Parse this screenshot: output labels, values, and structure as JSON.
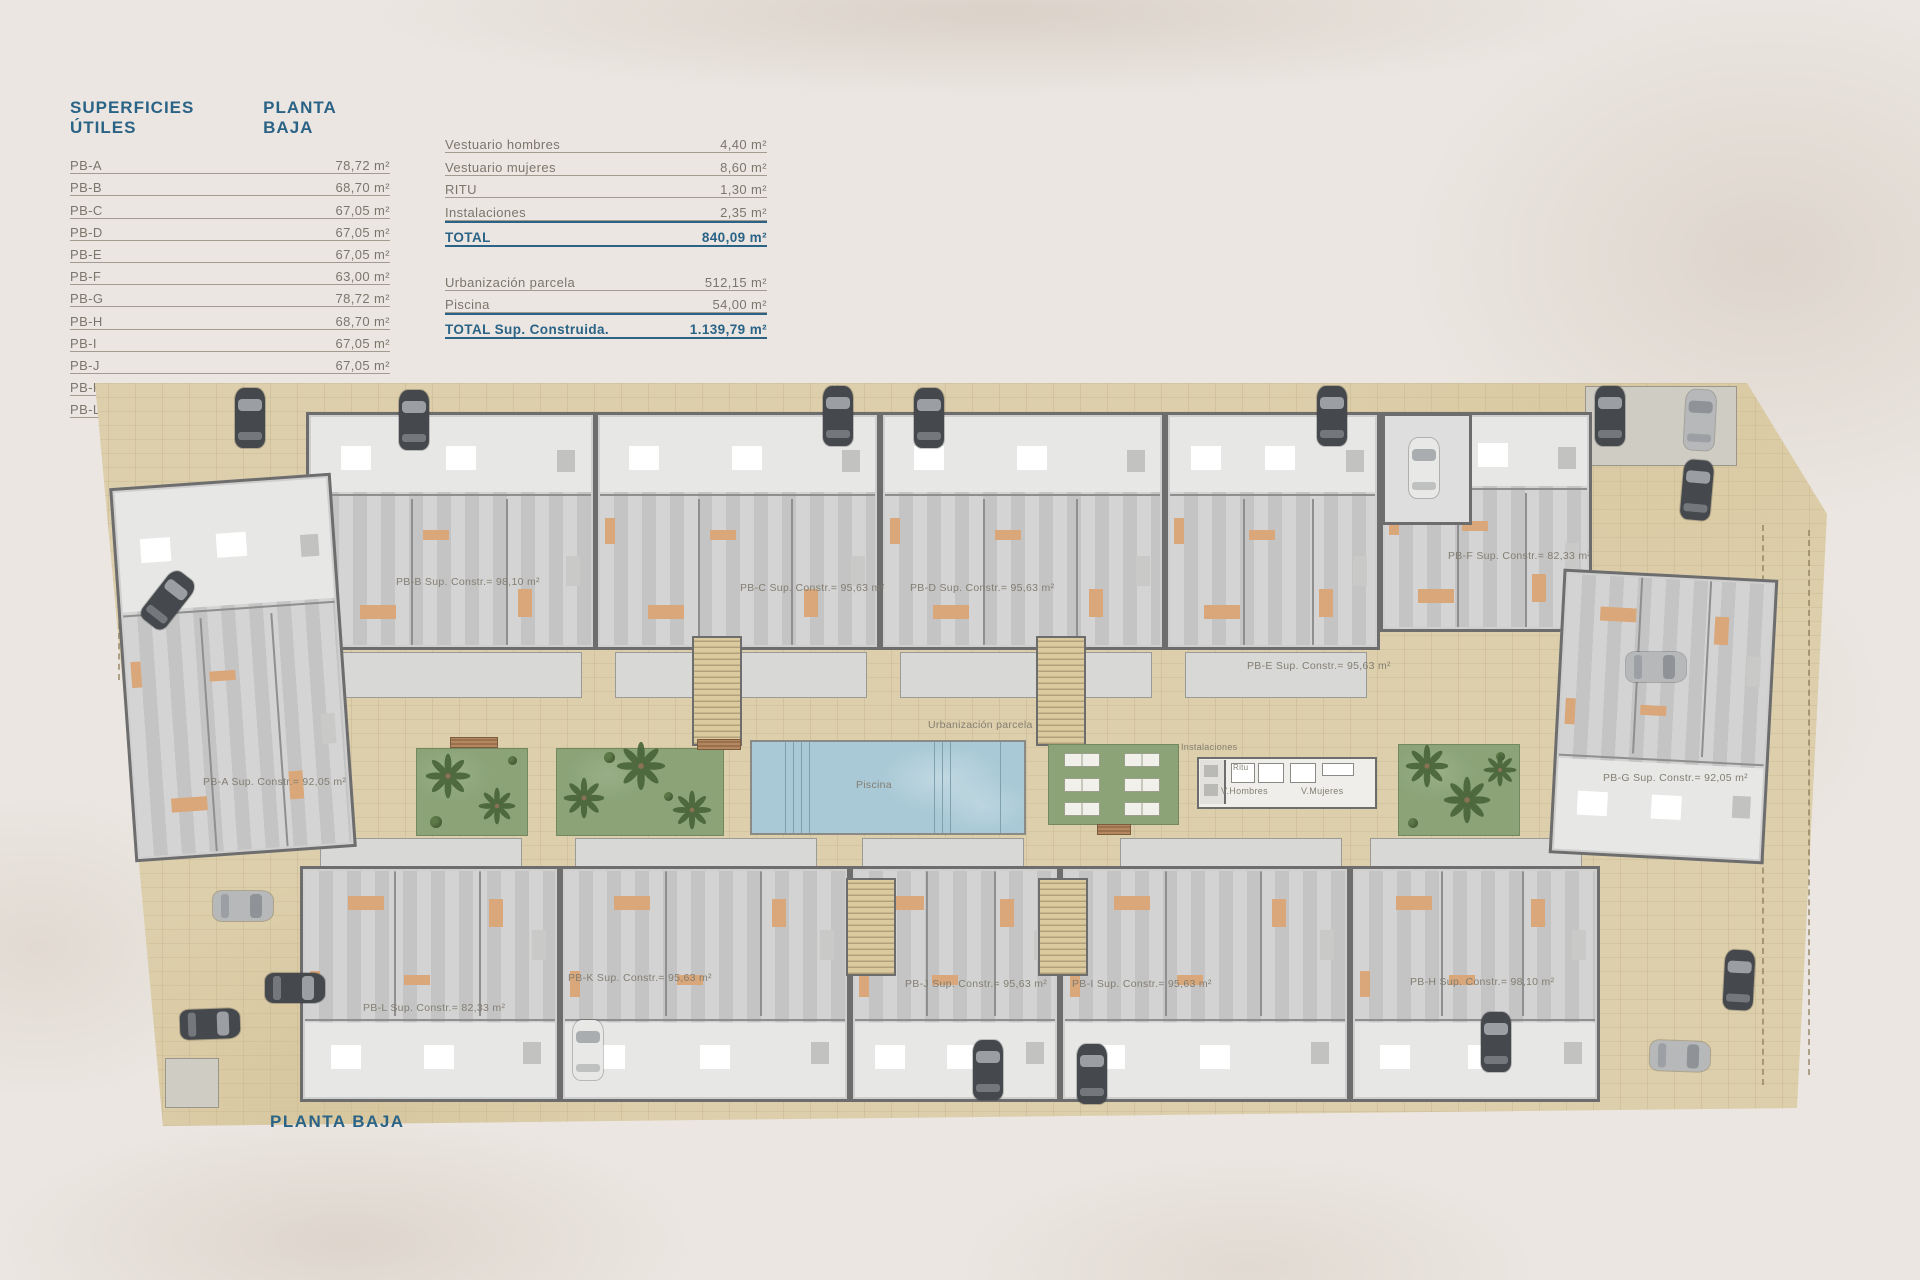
{
  "legend": {
    "title_left": "SUPERFICIES ÚTILES",
    "title_right": "PLANTA BAJA",
    "rows": [
      {
        "label": "PB-A",
        "value": "78,72 m²"
      },
      {
        "label": "PB-B",
        "value": "68,70 m²"
      },
      {
        "label": "PB-C",
        "value": "67,05 m²"
      },
      {
        "label": "PB-D",
        "value": "67,05 m²"
      },
      {
        "label": "PB-E",
        "value": "67,05 m²"
      },
      {
        "label": "PB-F",
        "value": "63,00 m²"
      },
      {
        "label": "PB-G",
        "value": "78,72 m²"
      },
      {
        "label": "PB-H",
        "value": "68,70 m²"
      },
      {
        "label": "PB-I",
        "value": "67,05 m²"
      },
      {
        "label": "PB-J",
        "value": "67,05 m²"
      },
      {
        "label": "PB-K",
        "value": "67,05 m²"
      },
      {
        "label": "PB-L",
        "value": "63,30 m²"
      }
    ]
  },
  "summary": {
    "rows1": [
      {
        "label": "Vestuario hombres",
        "value": "4,40 m²"
      },
      {
        "label": "Vestuario mujeres",
        "value": "8,60 m²"
      },
      {
        "label": "RITU",
        "value": "1,30 m²"
      },
      {
        "label": "Instalaciones",
        "value": "2,35 m²"
      }
    ],
    "total1": {
      "label": "TOTAL",
      "value": "840,09 m²"
    },
    "rows2": [
      {
        "label": "Urbanización parcela",
        "value": "512,15 m²"
      },
      {
        "label": "Piscina",
        "value": "54,00 m²"
      }
    ],
    "total2": {
      "label": "TOTAL Sup. Construida.",
      "value": "1.139,79 m²"
    }
  },
  "plan": {
    "title": "PLANTA BAJA",
    "units": [
      {
        "id": "PB-A",
        "label": "PB-A Sup. Constr.= 92,05 m²"
      },
      {
        "id": "PB-B",
        "label": "PB-B Sup. Constr.= 98,10 m²"
      },
      {
        "id": "PB-C",
        "label": "PB-C Sup. Constr.= 95,63 m²"
      },
      {
        "id": "PB-D",
        "label": "PB-D Sup. Constr.= 95,63 m²"
      },
      {
        "id": "PB-E",
        "label": "PB-E Sup. Constr.= 95,63 m²"
      },
      {
        "id": "PB-F",
        "label": "PB-F Sup. Constr.= 82,33 m²"
      },
      {
        "id": "PB-G",
        "label": "PB-G Sup. Constr.= 92,05 m²"
      },
      {
        "id": "PB-H",
        "label": "PB-H Sup. Constr.= 98,10 m²"
      },
      {
        "id": "PB-I",
        "label": "PB-I Sup. Constr.= 95,63 m²"
      },
      {
        "id": "PB-J",
        "label": "PB-J Sup. Constr.= 95,63 m²"
      },
      {
        "id": "PB-K",
        "label": "PB-K Sup. Constr.= 95,63 m²"
      },
      {
        "id": "PB-L",
        "label": "PB-L Sup. Constr.= 82,33 m²"
      }
    ],
    "labels": {
      "urbanizacion": "Urbanización parcela",
      "piscina": "Piscina",
      "instalaciones": "Instalaciones",
      "ritu": "Ritu",
      "v_hombres": "V.Hombres",
      "v_mujeres": "V.Mujeres"
    }
  },
  "colors": {
    "accent": "#2a6386",
    "ttext": "#7b766c",
    "tline": "#a19b90",
    "paving": "#ddcfab",
    "wall": "#6d6d6d",
    "floor": "#cfcfcf",
    "room": "#e7e7e5",
    "furn": "#d9a77a",
    "garden": "#8ba377",
    "palm": "#4a653a",
    "pool": "#a9c9d6",
    "stair": "#dcca9f",
    "cardark": "#45484d",
    "carsilver": "#b6b8ba",
    "carwhite": "#e8e8e6",
    "bg": "#ebe6e1"
  }
}
